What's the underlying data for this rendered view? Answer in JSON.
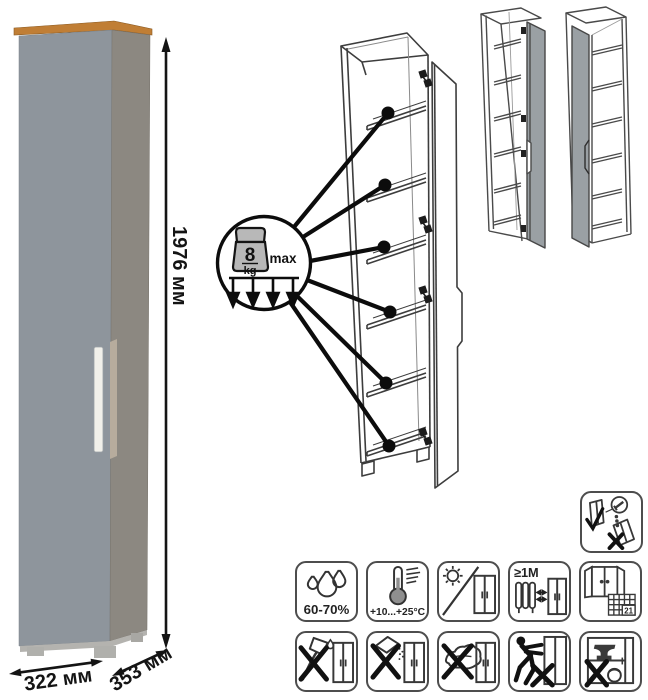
{
  "dimensions": {
    "height": "1976 мм",
    "width": "322 мм",
    "depth": "353 мм"
  },
  "shelf_load": {
    "value": "8",
    "unit": "kg",
    "qualifier": "max",
    "shelves": 6
  },
  "care_icons": {
    "row1": [
      {
        "name": "humidity-icon",
        "label": "60-70%"
      },
      {
        "name": "temperature-icon",
        "label": "+10...+25°C"
      },
      {
        "name": "no-direct-sunlight-icon",
        "label": ""
      },
      {
        "name": "heating-distance-icon",
        "label": "≥1M"
      },
      {
        "name": "ventilation-icon",
        "label": "21"
      }
    ],
    "row2": [
      {
        "name": "no-aggressive-liquids-icon"
      },
      {
        "name": "no-abrasive-powder-icon"
      },
      {
        "name": "no-abrasive-sponge-icon"
      },
      {
        "name": "no-pushing-icon"
      },
      {
        "name": "no-overload-icon"
      }
    ],
    "wall_mount": {
      "name": "wall-anchor-icon"
    }
  },
  "colors": {
    "wood_top": "#c07e35",
    "door": "#8e959c",
    "side_panel": "#8c8881",
    "handle": "#f1f0ea",
    "edge_strip": "#b7ac9d",
    "base": "#b4b3af",
    "variant_door": "#9aa0a4",
    "outline": "#3d3d3d"
  }
}
